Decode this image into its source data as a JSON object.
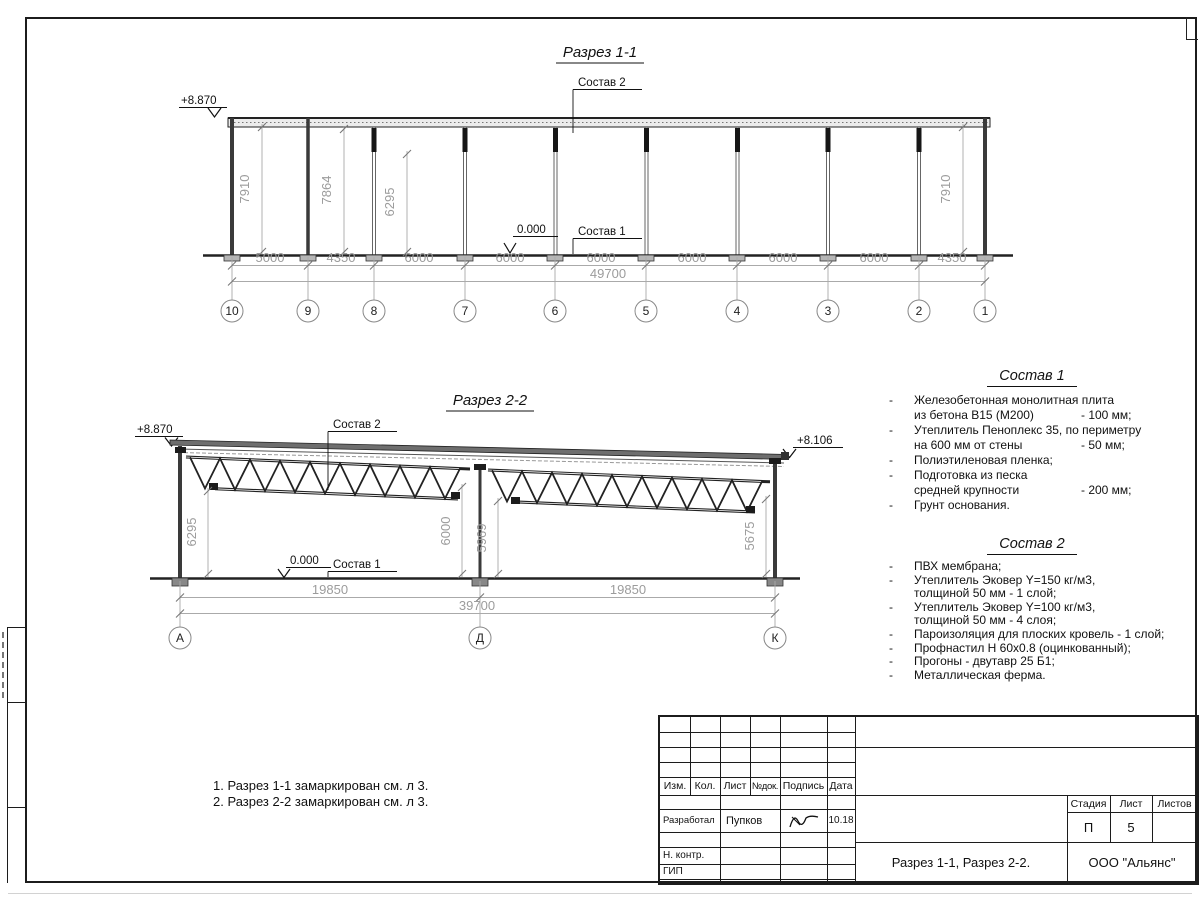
{
  "section1": {
    "title": "Разрез 1-1",
    "elev_left": "+8.870",
    "zero_mark": "0.000",
    "callout_top": "Состав 2",
    "callout_floor": "Состав 1",
    "vdims": [
      "7910",
      "7864",
      "6295",
      "7910"
    ],
    "bays": [
      "5000",
      "4350",
      "6000",
      "6000",
      "6000",
      "6000",
      "6000",
      "6000",
      "4350"
    ],
    "total": "49700",
    "grids": [
      "10",
      "9",
      "8",
      "7",
      "6",
      "5",
      "4",
      "3",
      "2",
      "1"
    ]
  },
  "section2": {
    "title": "Разрез 2-2",
    "elev_left": "+8.870",
    "elev_right": "+8.106",
    "zero_mark": "0.000",
    "callout_top": "Состав 2",
    "callout_floor": "Состав 1",
    "vdims": [
      "6295",
      "6000",
      "5969",
      "5675"
    ],
    "bays": [
      "19850",
      "19850"
    ],
    "total": "39700",
    "grids": [
      "А",
      "Д",
      "К"
    ]
  },
  "composition1": {
    "title": "Состав 1",
    "lines": [
      {
        "b": "-",
        "t": "Железобетонная  монолитная плита",
        "v": ""
      },
      {
        "b": "",
        "t": "из бетона В15 (М200)",
        "v": "- 100 мм;"
      },
      {
        "b": "-",
        "t": "Утеплитель Пеноплекс 35, по периметру",
        "v": ""
      },
      {
        "b": "",
        "t": "на 600 мм от стены",
        "v": "- 50 мм;"
      },
      {
        "b": "-",
        "t": "Полиэтиленовая пленка;",
        "v": ""
      },
      {
        "b": "-",
        "t": "Подготовка из песка",
        "v": ""
      },
      {
        "b": "",
        "t": "средней крупности",
        "v": "- 200 мм;"
      },
      {
        "b": "-",
        "t": "Грунт основания.",
        "v": ""
      }
    ]
  },
  "composition2": {
    "title": "Состав 2",
    "lines": [
      {
        "b": "-",
        "t": "ПВХ мембрана;"
      },
      {
        "b": "-",
        "t": "Утеплитель Эковер Y=150 кг/м3,"
      },
      {
        "b": "",
        "t": "толщиной 50 мм - 1 слой;"
      },
      {
        "b": "-",
        "t": "Утеплитель Эковер Y=100 кг/м3,"
      },
      {
        "b": "",
        "t": "толщиной 50 мм - 4 слоя;"
      },
      {
        "b": "-",
        "t": "Пароизоляция для плоских кровель - 1 слой;"
      },
      {
        "b": "-",
        "t": "Профнастил Н 60х0.8 (оцинкованный);"
      },
      {
        "b": "-",
        "t": "Прогоны - двутавр 25 Б1;"
      },
      {
        "b": "-",
        "t": "Металлическая ферма."
      }
    ]
  },
  "notes": [
    "1. Разрез 1-1 замаркирован см. л 3.",
    "2. Разрез 2-2 замаркирован см. л 3."
  ],
  "titleblock": {
    "h_izm": "Изм.",
    "h_kol": "Кол.",
    "h_list": "Лист",
    "h_ndok": "№док.",
    "h_podpis": "Подпись",
    "h_data": "Дата",
    "developed_label": "Разработал",
    "developed_name": "Пупков",
    "developed_date": "10.18",
    "ncontr_label": "Н. контр.",
    "gip_label": "ГИП",
    "stage_header": "Стадия",
    "sheet_header": "Лист",
    "sheets_header": "Листов",
    "stage_value": "П",
    "sheet_value": "5",
    "doc_title": "Разрез 1-1, Разрез 2-2.",
    "company": "ООО \"Альянс\""
  }
}
